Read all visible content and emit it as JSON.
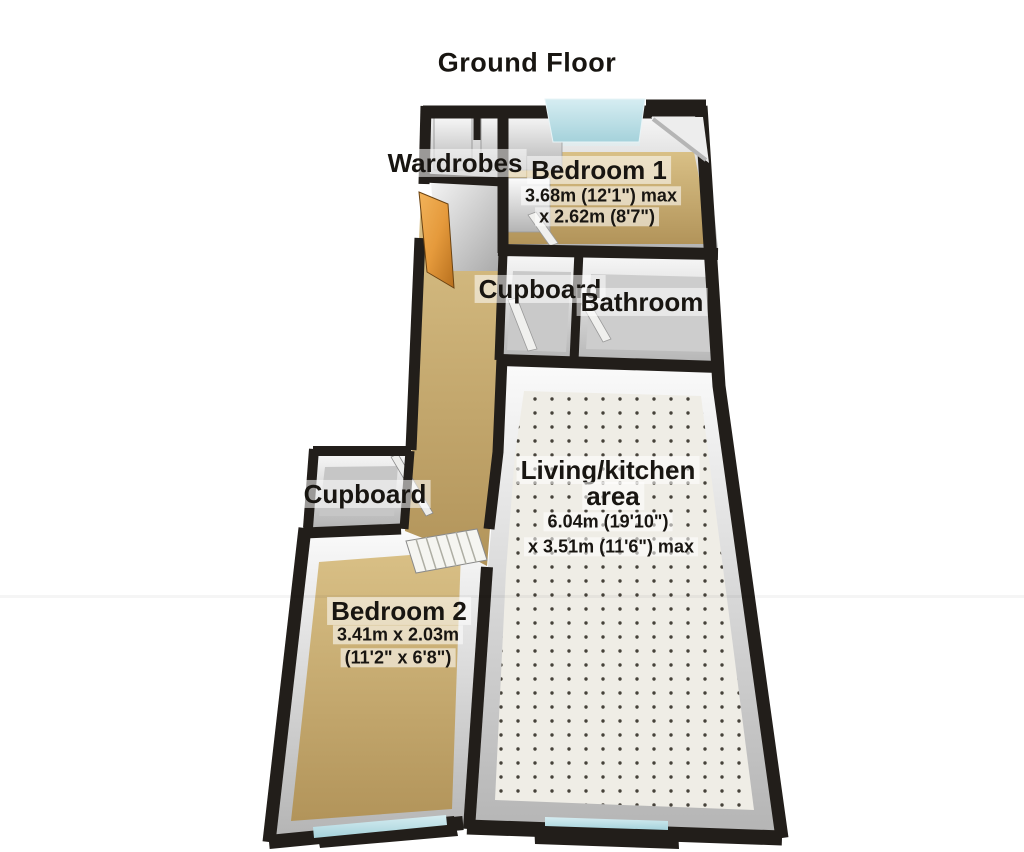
{
  "title": "Ground Floor",
  "rooms": {
    "wardrobes": {
      "label": "Wardrobes"
    },
    "bedroom1": {
      "label": "Bedroom 1",
      "dim1": "3.68m (12'1\") max",
      "dim2": "x 2.62m (8'7\")"
    },
    "cupboard1": {
      "label": "Cupboard"
    },
    "bathroom": {
      "label": "Bathroom"
    },
    "living": {
      "label": "Living/kitchen",
      "label2": "area",
      "dim1": "6.04m (19'10\")",
      "dim2": "x 3.51m (11'6\") max"
    },
    "cupboard2": {
      "label": "Cupboard"
    },
    "bedroom2": {
      "label": "Bedroom 2",
      "dim1": "3.41m x 2.03m",
      "dim2": "(11'2\" x 6'8\")"
    }
  },
  "colors": {
    "wall": "#221e1a",
    "floor-tan": "#c9ad6c",
    "floor-grey": "#c9c9c9",
    "carpet": "#efede6",
    "window": "#b8dde3",
    "door": "#e59a3c"
  }
}
